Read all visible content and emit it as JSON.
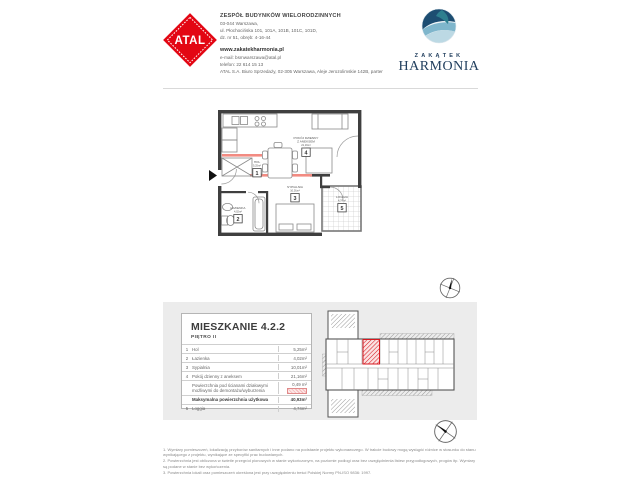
{
  "header": {
    "atal_logo_text": "ATAL",
    "address": {
      "line1": "ZESPÓŁ BUDYNKÓW WIELORODZINNYCH",
      "line2": "03-044 Warszawa,",
      "line3": "ul. Płochocińska 101, 101A, 101B, 101C, 101D,",
      "line4": "dz. nr 51, obręb: 4-16-44",
      "website": "www.zakatekharmonia.pl",
      "email": "e-mail: bsmwarszawa@atal.pl",
      "phone": "telefon: 22 614 15 13",
      "office": "ATAL S.A. Biuro Sprzedaży, 02-305 Warszawa, Aleje Jerozolimskie 142B, parter"
    },
    "harmonia_logo": {
      "top": "ZAKĄTEK",
      "bottom": "HARMONIA"
    }
  },
  "floor_plan": {
    "rooms": [
      {
        "num": "1",
        "label": "HOL",
        "area": "5,25m²"
      },
      {
        "num": "2",
        "label": "ŁAZIENKA",
        "area": "4,02m²"
      },
      {
        "num": "3",
        "label": "SYPIALNIA",
        "area": "10,01m²"
      },
      {
        "num": "4",
        "label1": "POKÓJ DZIENNY",
        "label2": "Z ANEKSEM",
        "area": "21,16m²"
      },
      {
        "num": "5",
        "label": "LOGGIA",
        "area": "4,74m²"
      }
    ]
  },
  "info_table": {
    "title": "MIESZKANIE 4.2.2",
    "floor": "PIĘTRO II",
    "rows": [
      {
        "no": "1",
        "name": "Hol",
        "value": "5,25m²"
      },
      {
        "no": "2",
        "name": "Łazienka",
        "value": "4,02m²"
      },
      {
        "no": "3",
        "name": "Sypialnia",
        "value": "10,01m²"
      },
      {
        "no": "4",
        "name": "Pokój dzienny z aneksem",
        "value": "21,16m²"
      },
      {
        "no": "",
        "name": "Powierzchnia pod ścianami działowymi możliwymi do demontażu/wyburzenia",
        "value": "0,49 m²"
      },
      {
        "no": "",
        "name": "Maksymalna powierzchnia użytkowa",
        "value": "40,93m²"
      },
      {
        "no": "5",
        "name": "Loggia",
        "value": "4,74m²"
      }
    ]
  },
  "footer": {
    "notes": [
      "1.  Wymiary pomieszczeń, lokalizację przyborów sanitarnych i inne podano na podstawie projektu wykonawczego. W trakcie budowy mogą wystąpić różnice w stosunku do stanu wynikającego z projektu, wynikające ze specyfiki prac budowlanych.",
      "2.  Powierzchnia jest obliczona w świetle przegród pionowych w stanie wykończonym, na poziomie podłogi oraz bez uwzględnienia listew przypodłogowych, progów itp. Wymiary są podane w stanie bez wykończenia.",
      "3.  Powierzchnia lokali oraz pomieszczeń określona jest przy uwzględnieniu treści Polskiej Normy PN-ISO 9836: 1997."
    ]
  },
  "colors": {
    "atal_red": "#e30613",
    "harmonia_navy": "#23405f",
    "wall_dark": "#3f3f3f",
    "demountable_wall_pink": "#f28b82",
    "highlight_red": "#d71920",
    "panel_gray": "#ececec"
  }
}
